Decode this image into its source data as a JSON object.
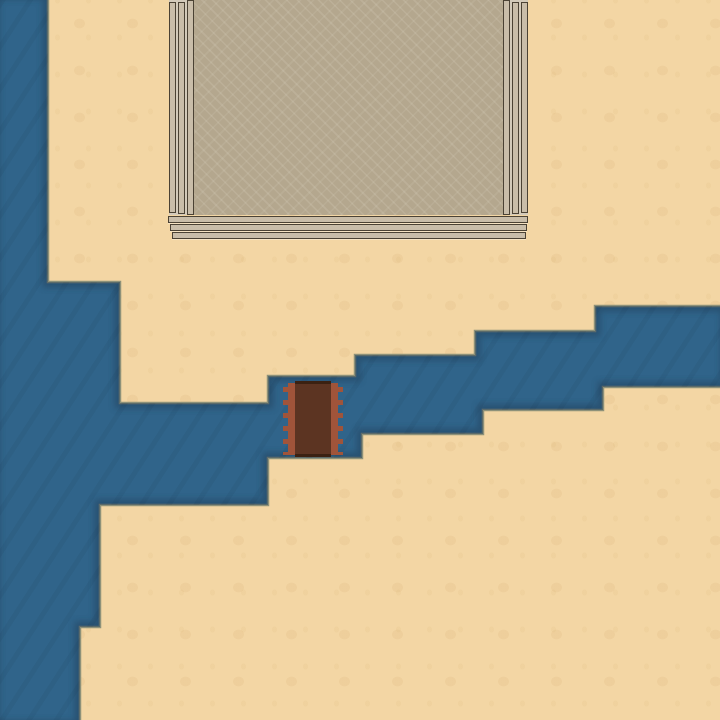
{
  "scene": {
    "type": "top-down-game-map",
    "description": "Desert sand terrain with a stepped blue river, a wooden plank bridge crossing the river, and a large stone building with columns and entrance steps at the top of the screen",
    "width": 720,
    "height": 720
  },
  "colors": {
    "sand": "#F3D6A4",
    "sand_mottle": "#E7C790",
    "water": "#30648A",
    "shore_line": "#8D9179",
    "shore_shadow": "#20405A",
    "wall": "#B4A78E",
    "wall_pattern": "#BFB39B",
    "trim_fill": "#C9BDA9",
    "trim_border": "#4B4234",
    "trim_bg": "#D3CABA",
    "bridge_deck": "#5C3422",
    "bridge_deck_edge": "#3B2112",
    "bridge_rail": "#A0543A"
  },
  "river": {
    "shape": "stepped-diagonal-channel-with-left-branch",
    "points": [
      [
        -6,
        -6
      ],
      [
        48,
        -6
      ],
      [
        48,
        282
      ],
      [
        120,
        282
      ],
      [
        120,
        403
      ],
      [
        268,
        403
      ],
      [
        268,
        376
      ],
      [
        355,
        376
      ],
      [
        355,
        355
      ],
      [
        475,
        355
      ],
      [
        475,
        331
      ],
      [
        595,
        331
      ],
      [
        595,
        306
      ],
      [
        726,
        306
      ],
      [
        726,
        387
      ],
      [
        603,
        387
      ],
      [
        603,
        410
      ],
      [
        483,
        410
      ],
      [
        483,
        434
      ],
      [
        362,
        434
      ],
      [
        362,
        458
      ],
      [
        268,
        458
      ],
      [
        268,
        505
      ],
      [
        100,
        505
      ],
      [
        100,
        627
      ],
      [
        80,
        627
      ],
      [
        80,
        726
      ],
      [
        -6,
        726
      ]
    ]
  },
  "building": {
    "wall": {
      "x": 193,
      "y": 0,
      "w": 310,
      "h": 215
    },
    "pillar_groups": [
      {
        "x": 169,
        "y": 0,
        "w": 25,
        "h": 215,
        "bars": [
          {
            "x": 0,
            "y": 2,
            "w": 7,
            "h": 211
          },
          {
            "x": 9,
            "y": 2,
            "w": 7,
            "h": 212
          },
          {
            "x": 18,
            "y": 0,
            "w": 7,
            "h": 215
          }
        ]
      },
      {
        "x": 503,
        "y": 0,
        "w": 25,
        "h": 215,
        "bars": [
          {
            "x": 0,
            "y": 0,
            "w": 7,
            "h": 215
          },
          {
            "x": 9,
            "y": 2,
            "w": 7,
            "h": 212
          },
          {
            "x": 18,
            "y": 2,
            "w": 7,
            "h": 211
          }
        ]
      }
    ],
    "steps": [
      {
        "x": 168,
        "y": 216,
        "w": 360,
        "h": 7
      },
      {
        "x": 170,
        "y": 224,
        "w": 357,
        "h": 7
      },
      {
        "x": 172,
        "y": 232,
        "w": 354,
        "h": 7
      }
    ]
  },
  "bridge": {
    "box": {
      "x": 283,
      "y": 381,
      "w": 60,
      "h": 76
    },
    "rail_w": 12,
    "notch_w": 5,
    "notch_period": 13
  }
}
